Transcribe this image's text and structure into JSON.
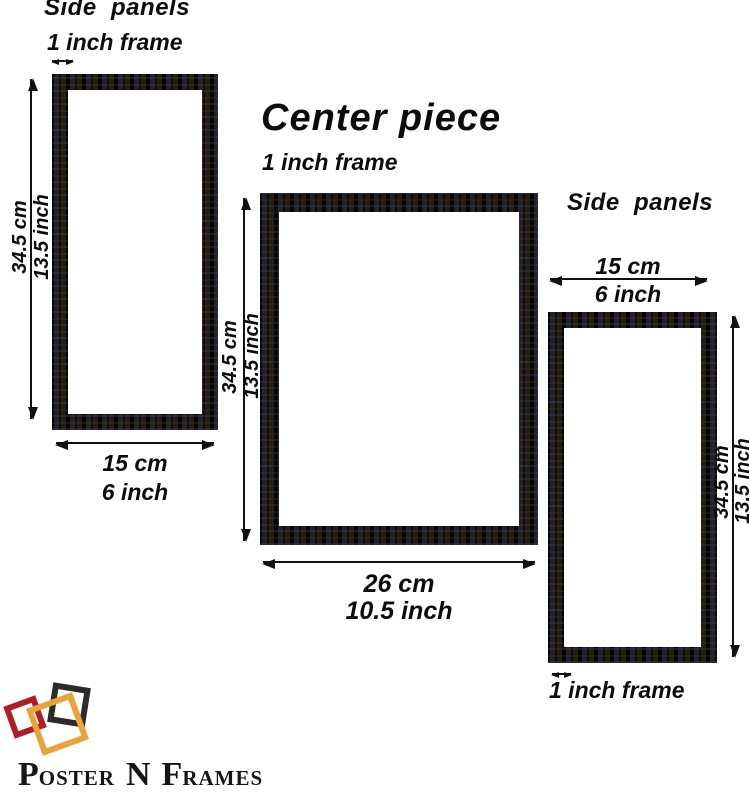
{
  "left_section": {
    "title": "Side  panels",
    "frame_thickness": "1 inch frame",
    "height_cm": "34.5 cm",
    "height_inch": "13.5 inch",
    "width_cm": "15 cm",
    "width_inch": "6 inch"
  },
  "center_section": {
    "title": "Center piece",
    "frame_thickness": "1 inch frame",
    "height_cm": "34.5 cm",
    "height_inch": "13.5 inch",
    "width_cm": "26 cm",
    "width_inch": "10.5 inch"
  },
  "right_section": {
    "title": "Side  panels",
    "width_cm": "15 cm",
    "width_inch": "6 inch",
    "height_cm": "34.5 cm",
    "height_inch": "13.5 inch",
    "frame_thickness": "1 inch frame"
  },
  "logo": {
    "name_parts": {
      "initial_1": "P",
      "rest_1": "OSTER",
      "middle": "N",
      "initial_2": "F",
      "rest_2": "RAMES"
    },
    "colors": {
      "red_square": "#ab1f26",
      "gold_square": "#e8a33d",
      "black_square": "#2b2b2b"
    }
  },
  "frame": {
    "color": "#14100c"
  }
}
